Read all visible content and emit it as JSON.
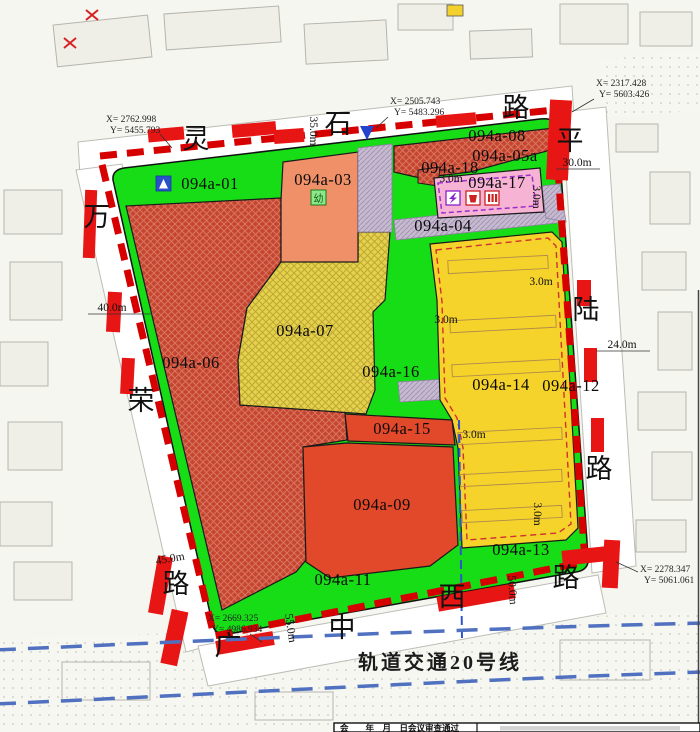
{
  "parcels": {
    "a01": {
      "label": "094a-01"
    },
    "a03": {
      "label": "094a-03"
    },
    "a04": {
      "label": "094a-04"
    },
    "a05a": {
      "label": "094a-05a"
    },
    "a06": {
      "label": "094a-06"
    },
    "a07": {
      "label": "094a-07"
    },
    "a08": {
      "label": "094a-08"
    },
    "a09": {
      "label": "094a-09"
    },
    "a11": {
      "label": "094a-11"
    },
    "a12": {
      "label": "094a-12"
    },
    "a13": {
      "label": "094a-13"
    },
    "a14": {
      "label": "094a-14"
    },
    "a15": {
      "label": "094a-15"
    },
    "a16": {
      "label": "094a-16"
    },
    "a17": {
      "label": "094a-17"
    },
    "a18": {
      "label": "094a-18"
    }
  },
  "streets": {
    "top": [
      "灵",
      "石",
      "路"
    ],
    "left": [
      "万",
      "荣",
      "路"
    ],
    "right": [
      "平",
      "陆",
      "路"
    ],
    "bottom": [
      "广",
      "中",
      "西",
      "路"
    ]
  },
  "metro_line_label": "轨道交通20号线",
  "coordinate_markers": [
    {
      "x": "X= 2762.998",
      "y": "Y= 5455.793"
    },
    {
      "x": "X= 2505.743",
      "y": "Y= 5483.296"
    },
    {
      "x": "X= 2317.428",
      "y": "Y= 5603.426"
    },
    {
      "x": "X= 2278.347",
      "y": "Y= 5061.061"
    },
    {
      "x": "X= 2669.325",
      "y": "Y= 4986.934"
    }
  ],
  "dims": {
    "w35": "35.0m",
    "w30": "30.0m",
    "w40": "40.0m",
    "w24": "24.0m",
    "w45": "45.0m",
    "w55": "55.0m",
    "w50": "50.0m",
    "g3": "3.0m"
  },
  "icons": {
    "kindergarten": "幼"
  },
  "approval_bar": {
    "left": "会　　年　月　日会议审查通过"
  },
  "colors": {
    "boundary_red": "#d60000",
    "green": "#16dd16",
    "red_hatch": "#c6452f",
    "red_solid": "#e2482a",
    "yellow_hatch": "#e4d14d",
    "yellow_solid": "#f6d32a",
    "orange": "#f09068",
    "pink": "#f7b3d4",
    "road_strip": "#c6bad0",
    "metro_blue": "#5070c0",
    "road_marking": "#e81515"
  }
}
